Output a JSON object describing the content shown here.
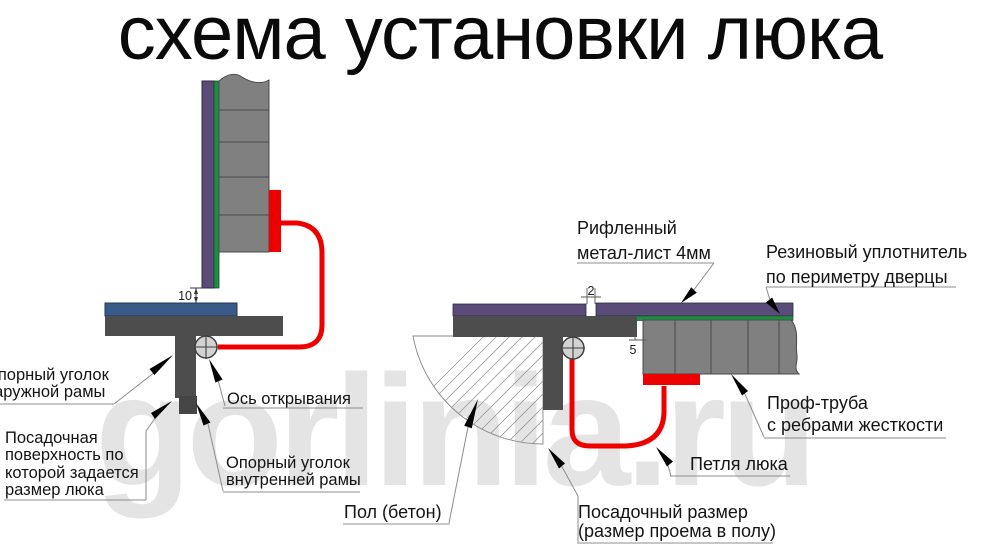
{
  "title": "схема установки люка",
  "watermark": "gorlinia.ru",
  "colors": {
    "sheet_purple": "#5b4b79",
    "seal_green": "#1f8c44",
    "profile_gray": "#808080",
    "frame_dark_gray": "#4d4d4d",
    "support_blue": "#3a5a88",
    "hinge_red": "#ee0000",
    "axis_circle_fill": "#d2d2d2",
    "watermark_gray": "#e4e4e4"
  },
  "left_view": {
    "dim_gap_bottom": "10",
    "labels": {
      "outer_frame_angle": {
        "lines": [
          "Опорный уголок",
          "наружной рамы"
        ]
      },
      "opening_axis": {
        "lines": [
          "Ось открывания"
        ]
      },
      "seating_surface": {
        "lines": [
          "Посадочная",
          "поверхность по",
          "которой задается",
          "размер люка"
        ]
      },
      "inner_frame_angle": {
        "lines": [
          "Опорный уголок",
          "внутренней рамы"
        ]
      }
    }
  },
  "right_view": {
    "dim_sheet_gap": "2",
    "dim_frame_gap": "5",
    "labels": {
      "sheet": {
        "lines": [
          "Рифленный",
          "метал-лист 4мм"
        ]
      },
      "seal": {
        "lines": [
          "Резиновый уплотнитель",
          "по периметру дверцы"
        ]
      },
      "tube": {
        "lines": [
          "Проф-труба",
          "с ребрами жесткости"
        ]
      },
      "hinge": {
        "lines": [
          "Петля люка"
        ]
      },
      "floor": {
        "lines": [
          "Пол (бетон)"
        ]
      },
      "opening_size": {
        "lines": [
          "Посадочный размер",
          "(размер проема в полу)"
        ]
      }
    }
  }
}
